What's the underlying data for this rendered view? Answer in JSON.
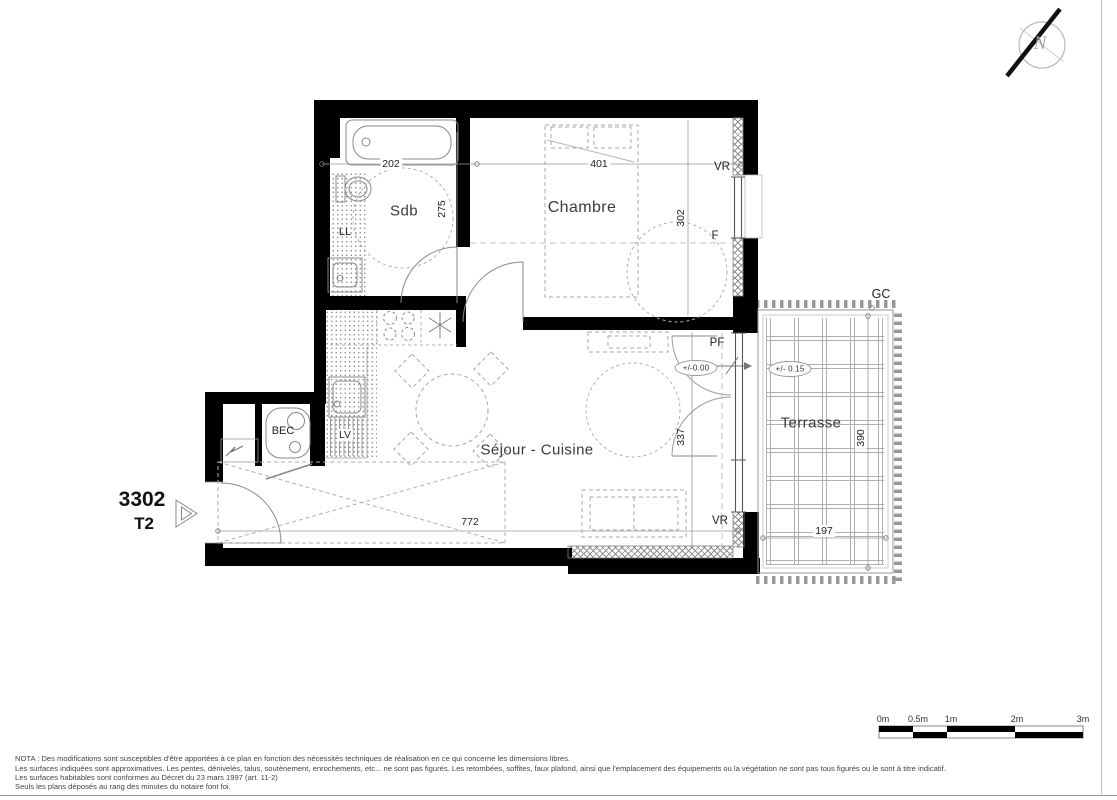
{
  "plan": {
    "unit": {
      "number": "3302",
      "type": "T2"
    },
    "rooms": {
      "bathroom": "Sdb",
      "bedroom": "Chambre",
      "living_kitchen": "Séjour - Cuisine",
      "terrace": "Terrasse",
      "water_heater_closet": "BEC"
    },
    "equipment": {
      "washing_machine": "LL",
      "dishwasher": "LV"
    },
    "openings": {
      "bedroom_shutter": "VR",
      "bedroom_window": "F",
      "living_french_door": "PF",
      "living_shutter": "VR",
      "terrace_railing": "GC"
    },
    "dimensions_cm": {
      "bathroom_width": "202",
      "bedroom_width": "401",
      "bathroom_depth": "275",
      "bedroom_depth": "302",
      "living_width": "772",
      "french_door_wall": "337",
      "terrace_width": "197",
      "terrace_depth": "390"
    },
    "levels": {
      "interior": "+/-0.00",
      "terrace": "+/- 0.15"
    }
  },
  "compass": {
    "north": "N"
  },
  "scale_bar": {
    "labels": [
      "0m",
      "0.5m",
      "1m",
      "2m",
      "3m"
    ]
  },
  "footer": {
    "lines": [
      "NOTA : Des modifications sont susceptibles d'être apportées à ce plan en fonction des nécessités techniques de réalisation en ce qui concerne les dimensions libres.",
      "Les surfaces indiquées sont approximatives. Les pentes, dénivelés, talus, soutènement, enrochements, etc... ne sont pas figurés. Les retombées, soffites, faux plafond, ainsi que l'emplacement des équipements ou la végétation ne sont pas tous figurés ou le sont à titre indicatif.",
      "Les surfaces habitables sont conformes au Décret du 23 mars 1997 (art. 11-2)",
      "Seuls les plans déposés au rang des minutes du notaire font foi."
    ]
  }
}
